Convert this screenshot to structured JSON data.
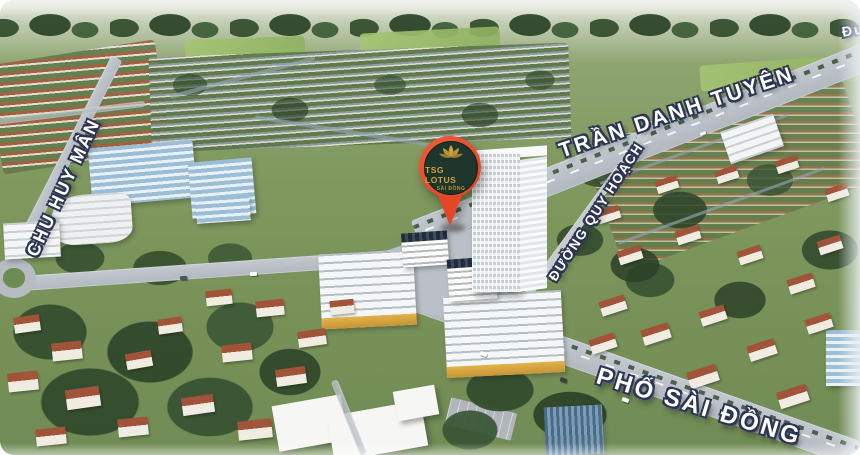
{
  "pin": {
    "title": "TSG LOTUS",
    "subtitle": "SÀI ĐỒNG"
  },
  "streets": {
    "chu_huy_man": "CHU HUY MÂN",
    "tran_danh_tuyen": "TRẦN DANH TUYÊN",
    "duong_quy_hoach": "ĐƯỜNG QUY HOẠCH",
    "pho_sai_dong": "PHỐ SÀI ĐỒNG",
    "edge_partial": "Đư"
  },
  "icons": {
    "pin": "location-pin-icon",
    "lotus": "lotus-icon"
  },
  "colors": {
    "pin_red": "#e64628",
    "pin_inner_green": "#1d352a",
    "pin_gold": "#cda33e",
    "label_fill": "#ffffff",
    "label_outline": "#2c3553",
    "road_grey": "#b8bec5",
    "grass_green": "#7e975f",
    "roof_terracotta": "#a2543a",
    "glass_blue": "#9cbdd6"
  }
}
